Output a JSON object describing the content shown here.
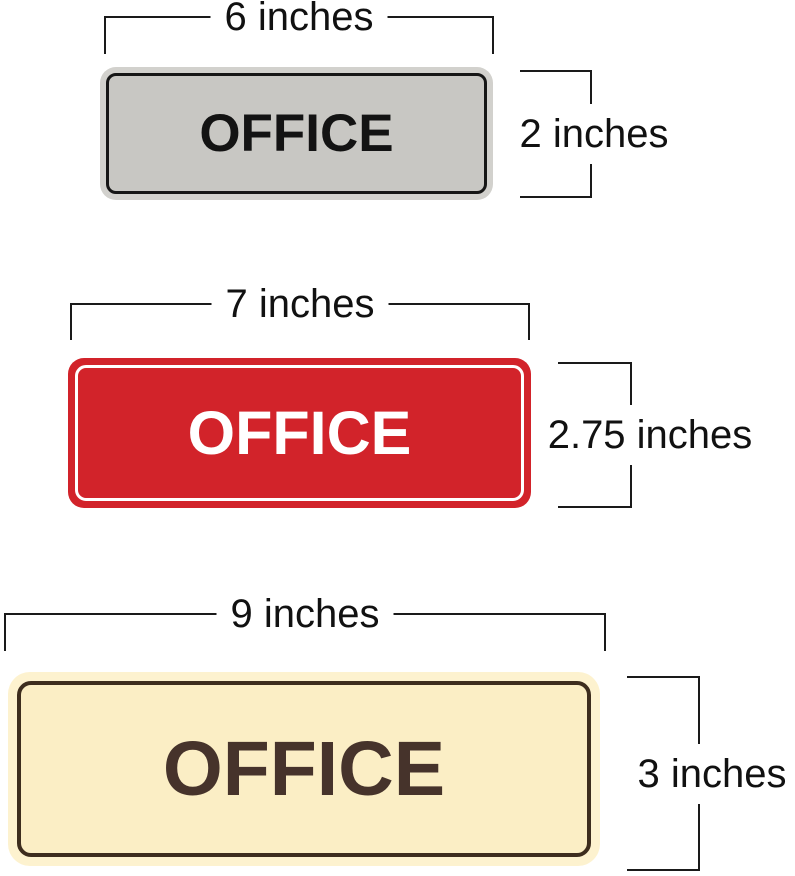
{
  "signs": [
    {
      "name": "small-gray-office-sign",
      "label": "OFFICE",
      "width_label": "6 inches",
      "height_label": "2 inches",
      "colors": {
        "edge": "#d2d1cd",
        "face": "#c8c7c3",
        "border": "#161616",
        "text": "#131313"
      }
    },
    {
      "name": "medium-red-office-sign",
      "label": "OFFICE",
      "width_label": "7 inches",
      "height_label": "2.75 inches",
      "colors": {
        "edge": "#d2232a",
        "face": "#d2232a",
        "border": "#ffffff",
        "text": "#ffffff"
      }
    },
    {
      "name": "large-cream-office-sign",
      "label": "OFFICE",
      "width_label": "9 inches",
      "height_label": "3 inches",
      "colors": {
        "edge": "#fdf2cf",
        "face": "#fbeec5",
        "border": "#3d2d1e",
        "text": "#46332b"
      }
    }
  ],
  "dimension_line_color": "#1a1a1a"
}
